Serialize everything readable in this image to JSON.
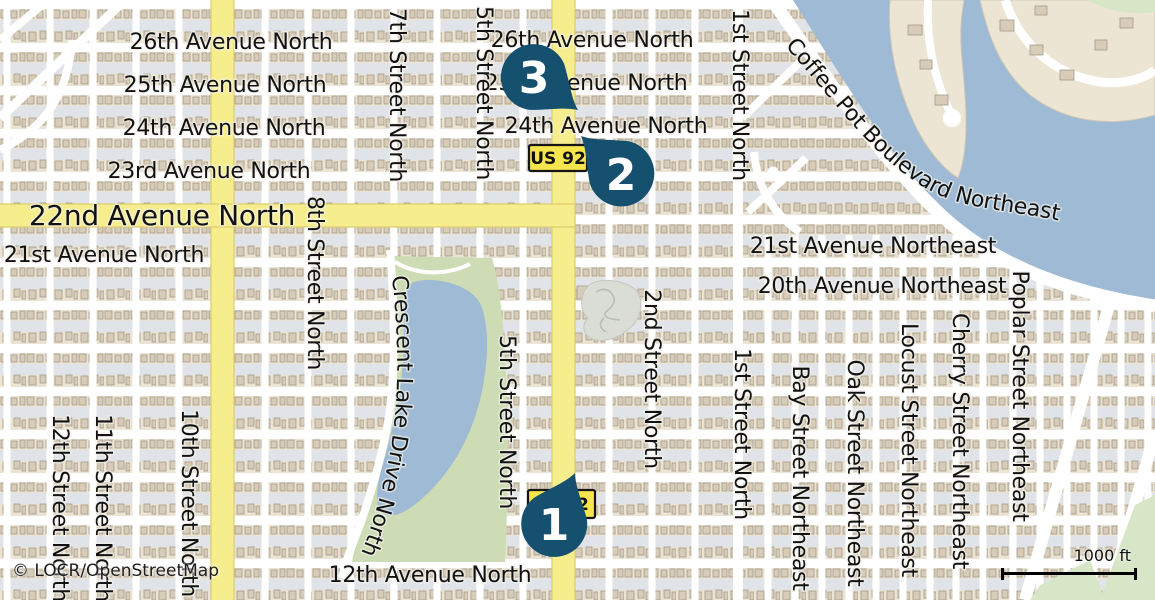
{
  "attribution": "© LOCR/OpenStreetMap",
  "scale": {
    "label": "1000 ft"
  },
  "shield": {
    "label": "US 92"
  },
  "markers": [
    {
      "label": "1"
    },
    {
      "label": "2"
    },
    {
      "label": "3"
    }
  ],
  "labels": {
    "avenues": [
      {
        "text": "26th Avenue North"
      },
      {
        "text": "25th Avenue North"
      },
      {
        "text": "24th Avenue North"
      },
      {
        "text": "23rd Avenue North"
      },
      {
        "text": "22nd Avenue North"
      },
      {
        "text": "21st Avenue North"
      },
      {
        "text": "21st Avenue Northeast"
      },
      {
        "text": "20th Avenue Northeast"
      },
      {
        "text": "12th Avenue North"
      }
    ],
    "streets": [
      {
        "text": "7th Street North"
      },
      {
        "text": "5th Street North"
      },
      {
        "text": "1st Street North"
      },
      {
        "text": "8th Street North"
      },
      {
        "text": "2nd Street North"
      },
      {
        "text": "12th Street North"
      },
      {
        "text": "11th Street North"
      },
      {
        "text": "10th Street North"
      },
      {
        "text": "Bay Street Northeast"
      },
      {
        "text": "Oak Street Northeast"
      },
      {
        "text": "Locust Street Northeast"
      },
      {
        "text": "Cherry Street Northeast"
      },
      {
        "text": "Poplar Street Northeast"
      }
    ],
    "curved": {
      "coffee_pot": "Coffee Pot Boulevard Northeast",
      "crescent_lake": "Crescent Lake Drive North"
    }
  },
  "colors": {
    "marker_fill": "#15506f",
    "route_yellow": "#f6ee8d",
    "shield_yellow": "#f7e54e",
    "water": "#9fbad4",
    "park_green": "#cddcb4",
    "land": "#f1efe9"
  }
}
